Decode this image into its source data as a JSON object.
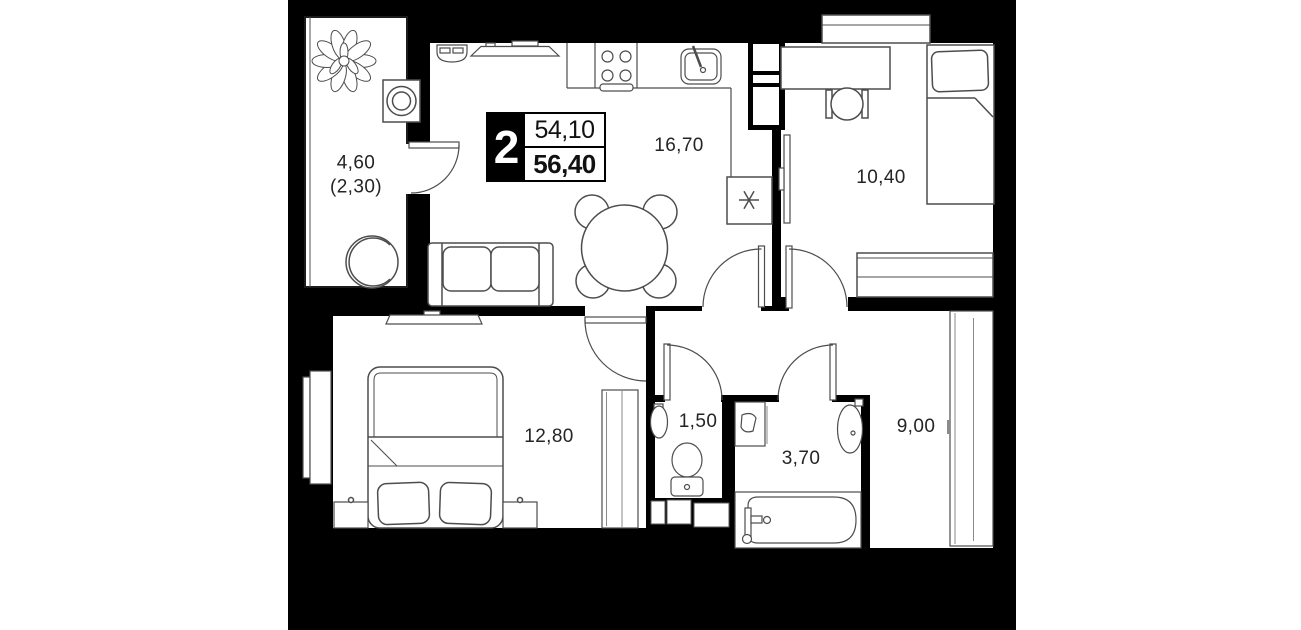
{
  "badge": {
    "rooms_count": "2",
    "living_area": "54,10",
    "total_area": "56,40"
  },
  "rooms": {
    "balcony": {
      "area": "4,60",
      "area_coeff": "(2,30)"
    },
    "kitchen_living": {
      "area": "16,70"
    },
    "bedroom_small": {
      "area": "10,40"
    },
    "bedroom_master": {
      "area": "12,80"
    },
    "toilet": {
      "area": "1,50"
    },
    "bathroom": {
      "area": "3,70"
    },
    "hallway": {
      "area": "9,00"
    }
  }
}
